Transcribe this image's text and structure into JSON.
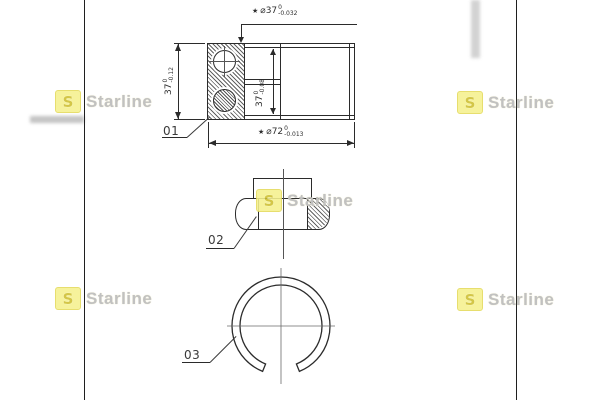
{
  "brand": {
    "logo_letter": "S",
    "name": "Starline",
    "logo_bg_color": "#f5f18e",
    "logo_letter_color": "#cdbf2e",
    "watermark_text_color": "#c1c1c1"
  },
  "part_labels": {
    "bearing": "01",
    "nut": "02",
    "snap_ring": "03"
  },
  "dimensions": {
    "bore_diameter": {
      "prefix": "★",
      "value": "⌀37",
      "tol_upper": "0",
      "tol_lower": "-0.032"
    },
    "outer_diameter": {
      "prefix": "★",
      "value": "⌀72",
      "tol_upper": "0",
      "tol_lower": "-0.013"
    },
    "overall_width": {
      "value": "37",
      "tol_upper": "0",
      "tol_lower": "-0.12"
    },
    "inner_width": {
      "value": "37",
      "tol_upper": "0",
      "tol_lower": "-0.08"
    }
  },
  "colors": {
    "line": "#2b2b2b",
    "background": "#ffffff"
  }
}
